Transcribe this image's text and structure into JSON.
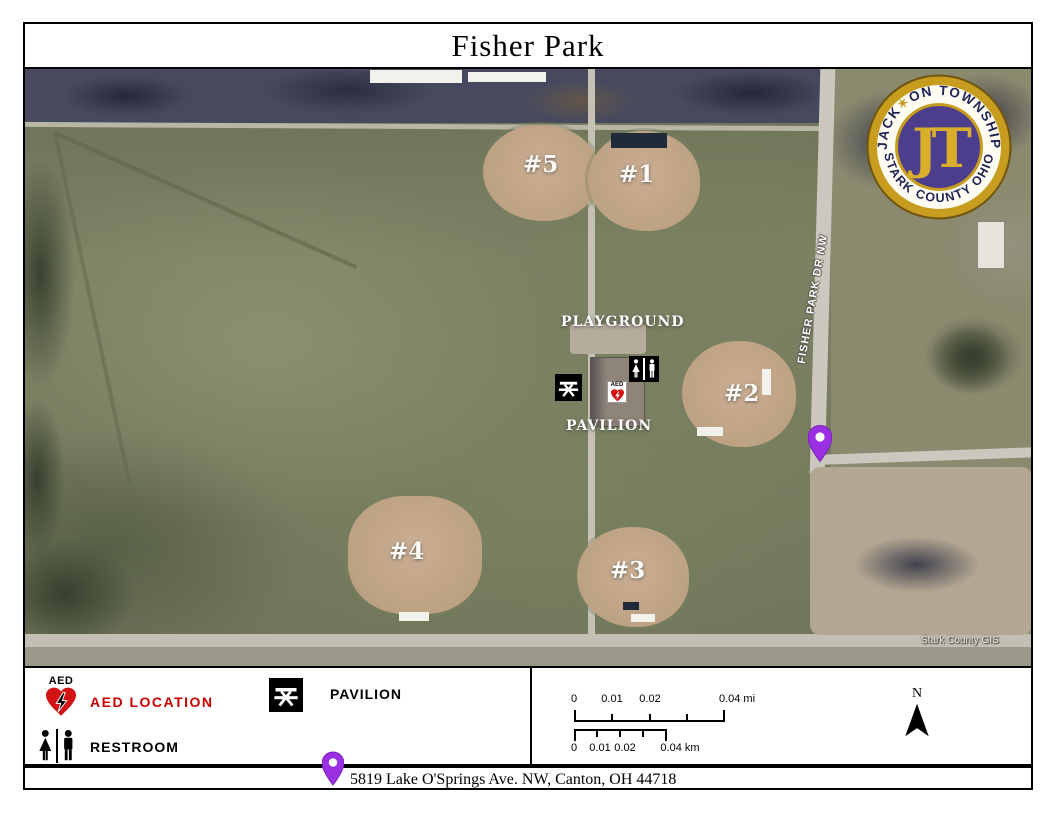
{
  "title": "Fisher Park",
  "logo": {
    "arc_top_1": "JACK",
    "arc_star": "✶",
    "arc_top_2": "ON TOWNSHIP",
    "arc_bottom": "STARK COUNTY OHIO",
    "monogram": "JT"
  },
  "map": {
    "field_labels": [
      "#5",
      "#1",
      "#2",
      "#4",
      "#3"
    ],
    "playground_label": "PLAYGROUND",
    "pavilion_label": "PAVILION",
    "road_label": "FISHER PARK DR NW",
    "credit": "Stark County GIS",
    "aed_icon_label": "AED"
  },
  "legend": {
    "aed_icon_label": "AED",
    "aed_label": "AED LOCATION",
    "restroom_label": "RESTROOM",
    "pavilion_label": "PAVILION",
    "scale_mi": [
      "0",
      "0.01",
      "0.02",
      "0.04 mi"
    ],
    "scale_km": [
      "0",
      "0.01",
      "0.02",
      "0.04 km"
    ],
    "north_label": "N"
  },
  "footer": {
    "address": "5819 Lake O'Springs Ave. NW, Canton, OH 44718"
  },
  "colors": {
    "accent_red": "#CC0000",
    "pin_purple": "#9B2FE2",
    "logo_gold": "#C79C1F",
    "logo_purple": "#4C3E8C",
    "field_tan": "#C2A88D",
    "grass_green": "#767A5E"
  }
}
